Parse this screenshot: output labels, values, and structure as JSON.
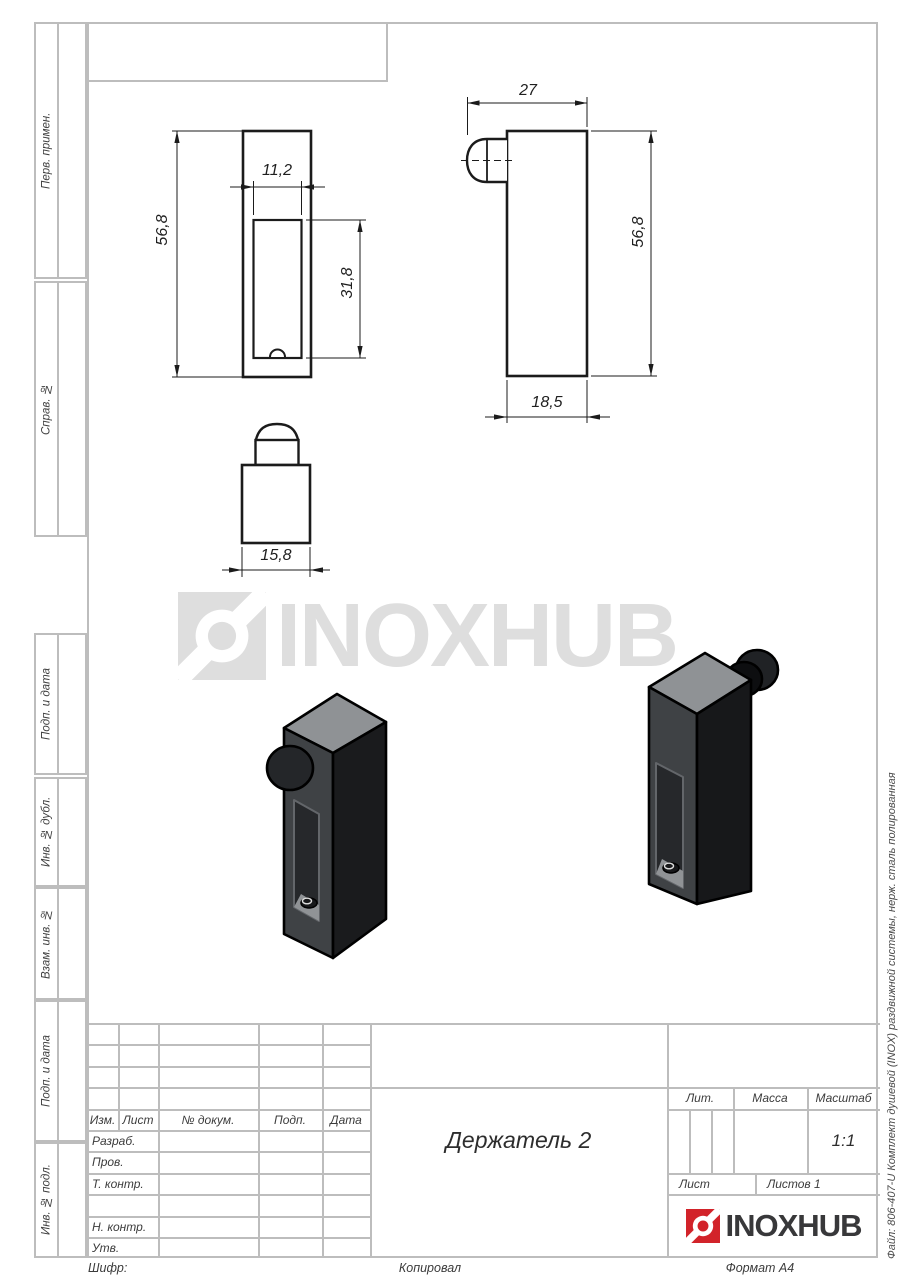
{
  "margin_labels": [
    "Перв. примен.",
    "Справ. №",
    "Подп. и дата",
    "Инв. № дубл.",
    "Взам. инв. №",
    "Подп. и дата",
    "Инв. № подл."
  ],
  "dims": {
    "front_height": "56,8",
    "front_slot_width": "11,2",
    "front_slot_height": "31,8",
    "side_width": "27",
    "side_height": "56,8",
    "side_body_width": "18,5",
    "top_width": "15,8"
  },
  "watermark": {
    "text": "INOXHUB"
  },
  "brand": {
    "name": "INOXHUB",
    "red": "#d2232a",
    "dark": "#38383a"
  },
  "title_block": {
    "revision_headers": [
      "Изм.",
      "Лист",
      "№ докум.",
      "Подп.",
      "Дата"
    ],
    "role_labels": [
      "Разраб.",
      "Пров.",
      "Т. контр.",
      "",
      "Н. контр.",
      "Утв."
    ],
    "part_title": "Держатель 2",
    "lit_label": "Лит.",
    "mass_label": "Масса",
    "scale_label": "Масштаб",
    "scale_value": "1:1",
    "sheet_label": "Лист",
    "sheets_label": "Листов 1"
  },
  "footer": {
    "left": "Шифр:",
    "center": "Копировал",
    "right": "Формат А4"
  },
  "side_note": "Файл: 806-407-U Комплект душевой (INOX) раздвижной системы, нерж. сталь полированная"
}
